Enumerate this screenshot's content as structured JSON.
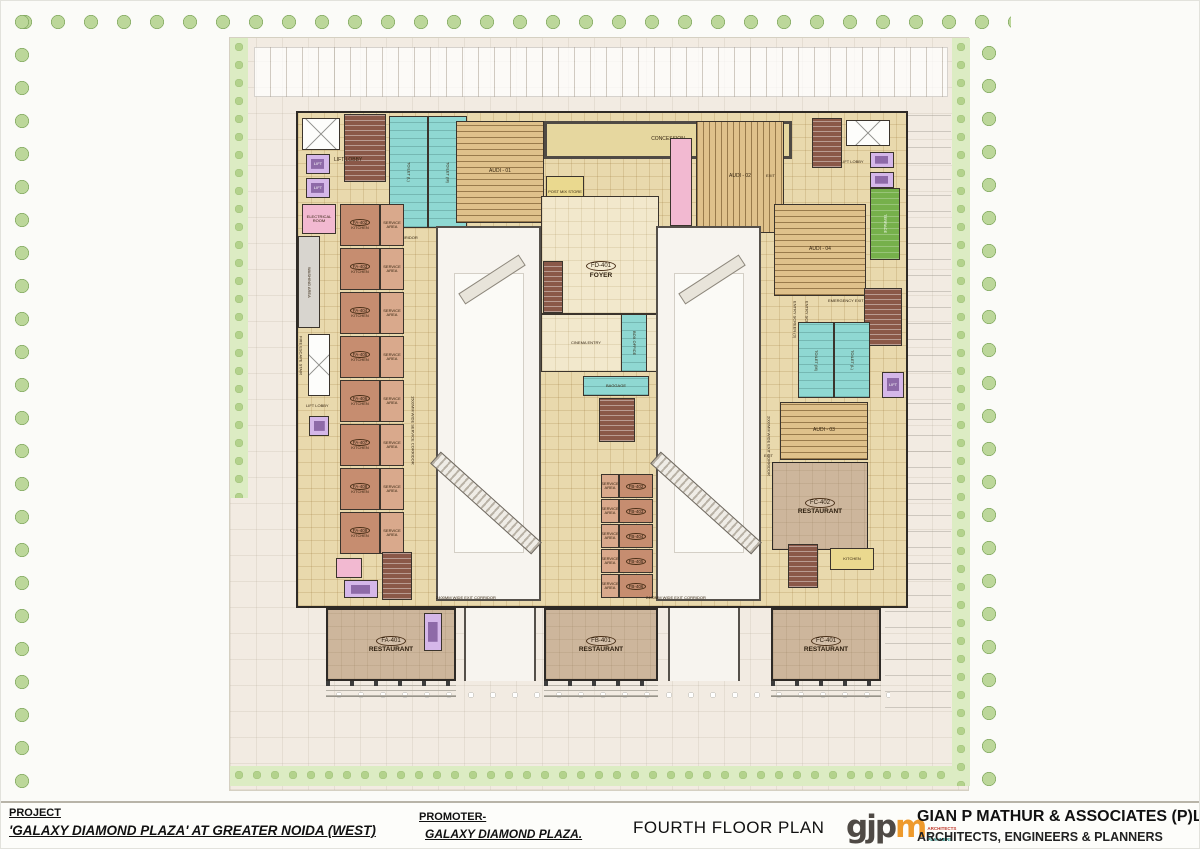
{
  "title_block": {
    "project_label": "PROJECT",
    "project_name": "'GALAXY DIAMOND PLAZA' AT GREATER NOIDA (WEST)",
    "promoter_label": "PROMOTER-",
    "promoter_name": "GALAXY DIAMOND PLAZA.",
    "drawing_title": "FOURTH FLOOR PLAN",
    "firm_name": "GIAN P MATHUR & ASSOCIATES (P)LTD",
    "firm_subtitle": "ARCHITECTS, ENGINEERS & PLANNERS",
    "logo_text_dark": "gjp",
    "logo_text_orange": "m",
    "logo_sub1": "ARCHITECTS",
    "logo_sub2": "& PLANNERS"
  },
  "plan": {
    "labels": {
      "corridor": "CORRIDOR",
      "concession": "CONCESSION",
      "audi1": "AUDI - 01",
      "audi2": "AUDI - 02",
      "audi3": "AUDI - 03",
      "audi4": "AUDI - 04",
      "post_mix": "POST MIX STORE",
      "manager": "MANAGER",
      "entry_screen_1": "ENTRY SCREEN (1)",
      "entry_screen_2": "ENTRY SCREEN (2)",
      "entry_screen_3": "ENTRY SCREEN (3)",
      "entry_screen_4": "ENTRY SCREEN (4)",
      "emergency_exit": "EMERGENCY EXIT",
      "foyer_id": "FD-401",
      "foyer": "FOYER",
      "cinema_entry": "CINEMA ENTRY",
      "box_office": "BOX OFFICE",
      "baggage": "BAGGAGE",
      "toilet_m": "TOILET (M)",
      "toilet_l": "TOILET (L)",
      "lift": "LIFT",
      "lift_lobby": "LIFT LOBBY",
      "electrical_room": "ELECTRICAL ROOM",
      "washing_area": "WASHING AREA",
      "fire_stair": "FIRE ESCAPE STAIR",
      "terrace": "TERRACE",
      "store": "STORE",
      "exit": "EXIT",
      "kitchen": "KITCHEN",
      "service_area": "SERVICE AREA",
      "exit_corridor_2400": "2400MM WIDE EXIT CORRIDOR",
      "exit_corridor_2000": "2000MM WIDE EXIT CORRIDOR",
      "service_corridor_1500": "1500MM WIDE SERVICE CORRIDOR"
    },
    "restaurants": {
      "fa401": {
        "id": "FA-401",
        "name": "RESTAURANT"
      },
      "fb401": {
        "id": "FB-401",
        "name": "RESTAURANT"
      },
      "fc401": {
        "id": "FC-401",
        "name": "RESTAURANT"
      },
      "fc402": {
        "id": "FC-402",
        "name": "RESTAURANT"
      }
    },
    "left_units": [
      {
        "id": "FA-402"
      },
      {
        "id": "FA-403"
      },
      {
        "id": "FA-404"
      },
      {
        "id": "FA-405"
      },
      {
        "id": "FA-406"
      },
      {
        "id": "FA-407"
      },
      {
        "id": "FA-408"
      },
      {
        "id": "FA-409"
      }
    ],
    "center_units": [
      {
        "id": "FB-402"
      },
      {
        "id": "FB-403"
      },
      {
        "id": "FB-404"
      },
      {
        "id": "FB-405"
      },
      {
        "id": "FB-406"
      }
    ],
    "colors": {
      "wall": "#2e2a26",
      "floor": "#e9d9ad",
      "toilet_teal": "#8fd8d2",
      "lift_purple": "#d5b7e9",
      "stair_brown": "#8a5848",
      "shop_salmon": "#c68d70",
      "service_salmon": "#d9a98c",
      "seating_tan": "#dfc18b",
      "terrace_green": "#76b04b",
      "electrical_pink": "#f2b9d1",
      "restaurant_tan": "#cdb69c",
      "hall_white": "#f7f4ef"
    }
  }
}
